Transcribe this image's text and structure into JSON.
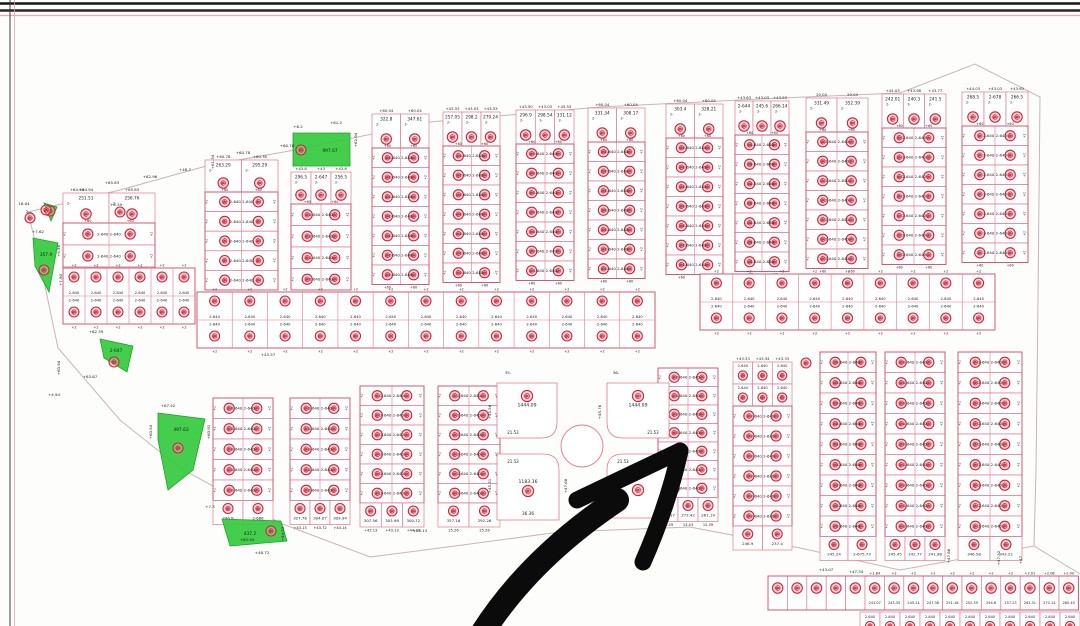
{
  "page": {
    "width": 1080,
    "height": 626,
    "background": "#fdfdfc",
    "kind": "scanned cadastral subdivision plan"
  },
  "palette": {
    "plot_line": "#e2798e",
    "block_line": "#cf5a72",
    "dark_line": "#2b2b2b",
    "stamp_red": "#c42a3a",
    "stamp_fill": "#f2a9b6",
    "green": "#35c93f",
    "text_dark": "#1d1d1d",
    "boundary": "#c9b4ba",
    "arrow_black": "#0b0b0b",
    "frame_black": "#161616",
    "frame_pink": "#d9a3ad"
  },
  "frame": {
    "top_lines": [
      {
        "y": 3.5,
        "color": "#141414",
        "w": 2.6,
        "opacity": 1
      },
      {
        "y": 10.5,
        "color": "#262626",
        "w": 2.4,
        "opacity": 1
      },
      {
        "y": 15.5,
        "color": "#d9a3ad",
        "w": 1.3,
        "opacity": 0.9
      }
    ],
    "left_lines": [
      {
        "x": 10,
        "color": "#3a3a3a",
        "w": 1.4,
        "opacity": 0.7
      },
      {
        "x": 14.5,
        "color": "#d9a3ad",
        "w": 1.0,
        "opacity": 0.75
      }
    ]
  },
  "boundary": {
    "outer": [
      [
        28,
        212
      ],
      [
        120,
        190
      ],
      [
        210,
        165
      ],
      [
        295,
        150
      ],
      [
        430,
        122
      ],
      [
        600,
        107
      ],
      [
        760,
        99
      ],
      [
        900,
        93
      ],
      [
        975,
        64
      ],
      [
        1040,
        97
      ],
      [
        1038,
        300
      ],
      [
        1036,
        470
      ],
      [
        1034,
        546
      ],
      [
        1080,
        574
      ]
    ],
    "lower": [
      [
        28,
        212
      ],
      [
        40,
        262
      ],
      [
        58,
        348
      ],
      [
        120,
        420
      ],
      [
        180,
        468
      ],
      [
        280,
        523
      ],
      [
        370,
        557
      ],
      [
        455,
        546
      ],
      [
        560,
        532
      ],
      [
        690,
        527
      ],
      [
        800,
        548
      ],
      [
        900,
        570
      ],
      [
        1034,
        546
      ]
    ]
  },
  "pair_label": "2-640",
  "row_end_mark": "+60",
  "side_tick": "+2",
  "top_strips": [
    {
      "x": 63,
      "y": 193,
      "w": 92,
      "top_h": 30,
      "rows": 3,
      "row_h": 22,
      "top_plots": [
        "251.51",
        "256.76"
      ],
      "top_labels": [
        "+64.94",
        "+65.83"
      ]
    },
    {
      "x": 205,
      "y": 160,
      "w": 73,
      "top_h": 32,
      "rows": 5,
      "row_h": 19.6,
      "top_plots": [
        "263.29",
        "295.29"
      ],
      "top_labels": [
        "+60.78",
        "+60.78"
      ]
    },
    {
      "x": 291,
      "y": 172,
      "w": 60,
      "top_h": 32,
      "rows": 4,
      "row_h": 21.5,
      "top_plots": [
        "296.5",
        "2-647",
        "256.5"
      ],
      "top_labels": [
        "+43.8",
        "+43",
        "+43.8"
      ]
    },
    {
      "x": 372,
      "y": 114,
      "w": 57,
      "top_h": 34,
      "rows": 7,
      "row_h": 19.5,
      "top_plots": [
        "322.8",
        "347.61"
      ],
      "top_labels": [
        "+60.04",
        "+60.04"
      ]
    },
    {
      "x": 443,
      "y": 112,
      "w": 57,
      "top_h": 34,
      "rows": 7,
      "row_h": 19.5,
      "top_plots": [
        "257.05",
        "298.2",
        "279.24"
      ],
      "top_labels": [
        "+43.53",
        "+43.03",
        "+43.53"
      ]
    },
    {
      "x": 516,
      "y": 110,
      "w": 58,
      "top_h": 34,
      "rows": 7,
      "row_h": 19.5,
      "top_plots": [
        "296.9",
        "298.54",
        "331.12"
      ],
      "top_labels": [
        "+43.50",
        "+43.03",
        "+43.53"
      ]
    },
    {
      "x": 588,
      "y": 108,
      "w": 57,
      "top_h": 34,
      "rows": 7,
      "row_h": 19.5,
      "top_plots": [
        "331.34",
        "308.17"
      ],
      "top_labels": [
        "+60.04",
        "+60.04"
      ]
    },
    {
      "x": 666,
      "y": 104,
      "w": 57,
      "top_h": 34,
      "rows": 7,
      "row_h": 19.5,
      "top_plots": [
        "303.4",
        "328.21"
      ],
      "top_labels": [
        "+60.04",
        "+60.04"
      ]
    },
    {
      "x": 735,
      "y": 101,
      "w": 54,
      "top_h": 34,
      "rows": 7,
      "row_h": 19.5,
      "top_plots": [
        "2-644",
        "245.6",
        "266.14"
      ],
      "top_labels": [
        "+43.63",
        "+43.03",
        "+43.53"
      ]
    },
    {
      "x": 806,
      "y": 98,
      "w": 62,
      "top_h": 34,
      "rows": 7,
      "row_h": 19.5,
      "top_plots": [
        "331.49",
        "352.39"
      ],
      "top_labels": [
        "20.04",
        "20.04"
      ]
    },
    {
      "x": 882,
      "y": 94,
      "w": 64,
      "top_h": 34,
      "rows": 7,
      "row_h": 19.5,
      "top_plots": [
        "242.01",
        "240.3",
        "241.5"
      ],
      "top_labels": [
        "+44.03",
        "+43.98",
        "+43.77"
      ]
    },
    {
      "x": 962,
      "y": 92,
      "w": 66,
      "top_h": 34,
      "rows": 7,
      "row_h": 19.5,
      "top_plots": [
        "268.5",
        "2-678",
        "266.5"
      ],
      "top_labels": [
        "+44.03",
        "+43.03",
        "+43.63"
      ]
    }
  ],
  "bands": [
    {
      "x": 63,
      "y": 268,
      "w": 132,
      "h": 56,
      "cols": 6
    },
    {
      "x": 197,
      "y": 292,
      "w": 458,
      "h": 56,
      "cols": 13
    },
    {
      "x": 700,
      "y": 274,
      "w": 295,
      "h": 56,
      "cols": 9
    }
  ],
  "lower_blocks": [
    {
      "x": 213,
      "y": 398,
      "w": 60,
      "rows": 5,
      "row_h": 20.5,
      "bottom_plots": [
        "246.8",
        "2-668"
      ],
      "below": []
    },
    {
      "x": 290,
      "y": 398,
      "w": 60,
      "rows": 5,
      "row_h": 20.5,
      "bottom_plots": [
        "327.76",
        "304.07",
        "309.94"
      ],
      "below": [
        "+43.13",
        "+43.72",
        "+44.14"
      ]
    },
    {
      "x": 360,
      "y": 386,
      "w": 64,
      "rows": 6,
      "row_h": 19.5,
      "bottom_plots": [
        "307.56",
        "303.98",
        "300.72"
      ],
      "below": [
        "+43.13",
        "+43.13",
        "+44.14"
      ]
    },
    {
      "x": 438,
      "y": 386,
      "w": 62,
      "rows": 6,
      "row_h": 19.5,
      "bottom_plots": [
        "357.16",
        "292.26"
      ],
      "below": [
        "25.26",
        "25.26"
      ]
    },
    {
      "x": 658,
      "y": 368,
      "w": 60,
      "rows": 7,
      "row_h": 18.5,
      "bottom_plots": [
        "261.17",
        "273.42",
        "261.19"
      ],
      "below": [
        "12.49",
        "13.43",
        "12.39"
      ]
    },
    {
      "x": 733,
      "y": 362,
      "w": 59,
      "rows": 6,
      "row_h": 20,
      "mini_rows": 2,
      "mini_h": 22,
      "top_labels": [
        "+43.33",
        "+43.34",
        "+43.33"
      ],
      "bottom_plots": [
        "246.9",
        "237.4"
      ],
      "below": []
    },
    {
      "x": 820,
      "y": 352,
      "w": 56,
      "rows": 9,
      "row_h": 20.5,
      "bottom_plots": [
        "245.24",
        "2-675.73"
      ],
      "below": []
    },
    {
      "x": 885,
      "y": 352,
      "w": 60,
      "rows": 9,
      "row_h": 20.5,
      "bottom_plots": [
        "245.45",
        "242.77",
        "241.98"
      ],
      "below": []
    },
    {
      "x": 958,
      "y": 352,
      "w": 64,
      "rows": 9,
      "row_h": 20.5,
      "bottom_plots": [
        "346.58",
        "343.22"
      ],
      "below": []
    }
  ],
  "roundabout": {
    "cx": 582,
    "cy": 446,
    "r": 21,
    "quadrants": [
      {
        "pos": "tl",
        "x": 497,
        "y": 383,
        "w": 60,
        "h": 55,
        "area": "1444.09",
        "corner": "21.53",
        "bottom": ""
      },
      {
        "pos": "tr",
        "x": 607,
        "y": 383,
        "w": 62,
        "h": 55,
        "area": "1444.09",
        "corner": "21.53",
        "bottom": ""
      },
      {
        "pos": "bl",
        "x": 497,
        "y": 454,
        "w": 62,
        "h": 66,
        "area": "1183.36",
        "corner": "21.53",
        "bottom": "36.36"
      },
      {
        "pos": "br",
        "x": 607,
        "y": 454,
        "w": 62,
        "h": 64,
        "area": "",
        "corner": "21.53",
        "bottom": ""
      }
    ]
  },
  "green_areas": [
    {
      "label": "997.67",
      "lx": 330,
      "ly": 152,
      "sx": 301,
      "sy": 150,
      "pts": [
        [
          293,
          133
        ],
        [
          350,
          133
        ],
        [
          350,
          166
        ],
        [
          293,
          166
        ]
      ]
    },
    {
      "label": "357.9",
      "lx": 46,
      "ly": 256,
      "sx": 44,
      "sy": 270,
      "pts": [
        [
          33,
          238
        ],
        [
          58,
          243
        ],
        [
          49,
          292
        ],
        [
          35,
          266
        ]
      ]
    },
    {
      "label": "",
      "lx": 0,
      "ly": 0,
      "sx": 50,
      "sy": 211,
      "pts": [
        [
          44,
          203
        ],
        [
          57,
          207
        ],
        [
          51,
          221
        ]
      ]
    },
    {
      "label": "2-647",
      "lx": 116,
      "ly": 352,
      "sx": 114,
      "sy": 362,
      "pts": [
        [
          100,
          339
        ],
        [
          133,
          346
        ],
        [
          127,
          372
        ],
        [
          104,
          358
        ]
      ]
    },
    {
      "label": "497.63",
      "lx": 181,
      "ly": 431,
      "sx": 178,
      "sy": 448,
      "pts": [
        [
          158,
          413
        ],
        [
          205,
          419
        ],
        [
          193,
          470
        ],
        [
          168,
          490
        ],
        [
          158,
          440
        ]
      ]
    },
    {
      "label": "437.2",
      "lx": 250,
      "ly": 535,
      "sx": 271,
      "sy": 531,
      "pts": [
        [
          222,
          519
        ],
        [
          281,
          521
        ],
        [
          287,
          541
        ],
        [
          230,
          546
        ]
      ]
    }
  ],
  "bottom_strip": {
    "x": 768,
    "y": 576,
    "h": 34,
    "col_w": 19.4,
    "cols": 16,
    "ticks": [
      "",
      "",
      "",
      "",
      "",
      "+1.84",
      "+2",
      "+2",
      "+2",
      "+2",
      "+2",
      "+2",
      "+2",
      "+2.01",
      "+2.08",
      "+2.00"
    ],
    "numbers": [
      "",
      "",
      "",
      "",
      "",
      "241.07",
      "243.35",
      "245.14",
      "247.36",
      "251.18",
      "252.39",
      "254.6",
      "257.23",
      "261.31",
      "270.14",
      "260.40"
    ],
    "second_row": {
      "x": 860,
      "y": 612,
      "cols": 11,
      "col_w": 20,
      "label": "2-640"
    }
  },
  "loose_stamps": [
    [
      806,
      363
    ],
    [
      30,
      218
    ],
    [
      46,
      210
    ],
    [
      120,
      212
    ]
  ],
  "edge_labels": [
    {
      "x": 24,
      "y": 205,
      "t": "16.04"
    },
    {
      "x": 29,
      "y": 213,
      "t": "2—"
    },
    {
      "x": 116,
      "y": 206,
      "t": "+6.39"
    },
    {
      "x": 38,
      "y": 233,
      "t": "+7.62"
    },
    {
      "x": 60,
      "y": 251,
      "t": "+9.56",
      "v": 1
    },
    {
      "x": 62,
      "y": 280,
      "t": "+7.90",
      "v": 1
    },
    {
      "x": 77,
      "y": 191,
      "t": "+64.94"
    },
    {
      "x": 112,
      "y": 184,
      "t": "+65.83"
    },
    {
      "x": 150,
      "y": 178,
      "t": "+62.96"
    },
    {
      "x": 185,
      "y": 171,
      "t": "+48.7"
    },
    {
      "x": 214,
      "y": 162,
      "t": "+61.34",
      "v": 1
    },
    {
      "x": 243,
      "y": 154,
      "t": "+60.78"
    },
    {
      "x": 287,
      "y": 147,
      "t": "+60.78"
    },
    {
      "x": 298,
      "y": 128,
      "t": "+6.2"
    },
    {
      "x": 336,
      "y": 124,
      "t": "+61.2"
    },
    {
      "x": 357,
      "y": 140,
      "t": "+62.94",
      "v": 1
    },
    {
      "x": 268,
      "y": 356,
      "t": "+43.57"
    },
    {
      "x": 96,
      "y": 333,
      "t": "+62.39"
    },
    {
      "x": 60,
      "y": 368,
      "t": "+60.94",
      "v": 1
    },
    {
      "x": 90,
      "y": 378,
      "t": "+63.67"
    },
    {
      "x": 54,
      "y": 396,
      "t": "+4.94"
    },
    {
      "x": 168,
      "y": 407,
      "t": "+67.42"
    },
    {
      "x": 210,
      "y": 432,
      "t": "+60.91",
      "v": 1
    },
    {
      "x": 152,
      "y": 432,
      "t": "+60.54",
      "v": 1
    },
    {
      "x": 210,
      "y": 508,
      "t": "+7.3"
    },
    {
      "x": 247,
      "y": 541,
      "t": "+63.94"
    },
    {
      "x": 284,
      "y": 534,
      "t": "+44.53",
      "v": 1
    },
    {
      "x": 262,
      "y": 554,
      "t": "+48.72"
    },
    {
      "x": 420,
      "y": 532,
      "t": "+43.13"
    },
    {
      "x": 491,
      "y": 412,
      "t": "+45.56",
      "v": 1
    },
    {
      "x": 601,
      "y": 412,
      "t": "+45.76",
      "v": 1
    },
    {
      "x": 491,
      "y": 486,
      "t": "+45.31",
      "v": 1
    },
    {
      "x": 567,
      "y": 486,
      "t": "+47.68",
      "v": 1
    },
    {
      "x": 508,
      "y": 374,
      "t": "35-"
    },
    {
      "x": 616,
      "y": 374,
      "t": "36-"
    },
    {
      "x": 856,
      "y": 573,
      "t": "+47.34"
    },
    {
      "x": 826,
      "y": 571,
      "t": "+43.07"
    },
    {
      "x": 950,
      "y": 556,
      "t": "+47.86",
      "v": 1
    },
    {
      "x": 1000,
      "y": 558,
      "t": "+47.32",
      "v": 1
    },
    {
      "x": 1022,
      "y": 560,
      "t": "+47",
      "v": 1
    }
  ],
  "arrow": {
    "shaft": "M 472 650 Q 520 565 617 500",
    "barb_upper": "M 577 500 L 680 451",
    "barb_lower": "M 680 451 Q 668 505 643 562",
    "width_shaft": 24,
    "width_barb": 17,
    "color": "#0b0b0b"
  }
}
